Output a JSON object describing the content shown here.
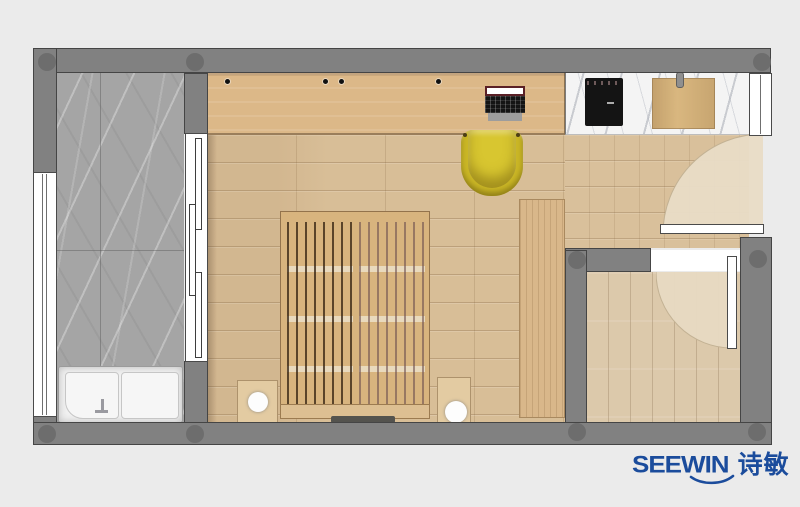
{
  "logo": {
    "brand": "SEEWIN",
    "cjk": "诗敏"
  },
  "colors": {
    "bg": "#ebebeb",
    "wall": "#818181",
    "wallEdge": "#454545",
    "wallDot": "#6d6d6d",
    "bathMarble": "#a5a5a5",
    "counter": "#f4f4f4",
    "floor": "#d8be97",
    "entryFloor": "#d9c09b",
    "room2Floor": "#dcc9ab",
    "swing": "#e8dcc6",
    "desk": "#dcb888",
    "bed": "#d8b47e",
    "wardrobe": "#d9b78a",
    "nightstand": "#e3cba2",
    "chair": "#cbb726",
    "chairInner": "#d8c630",
    "tub": "#f1f1f1",
    "cooktop": "#141414",
    "board": "#d9b77f",
    "frame": "#ffffff",
    "frameEdge": "#4a4a4a",
    "logoBlue": "#1b4c9c"
  }
}
